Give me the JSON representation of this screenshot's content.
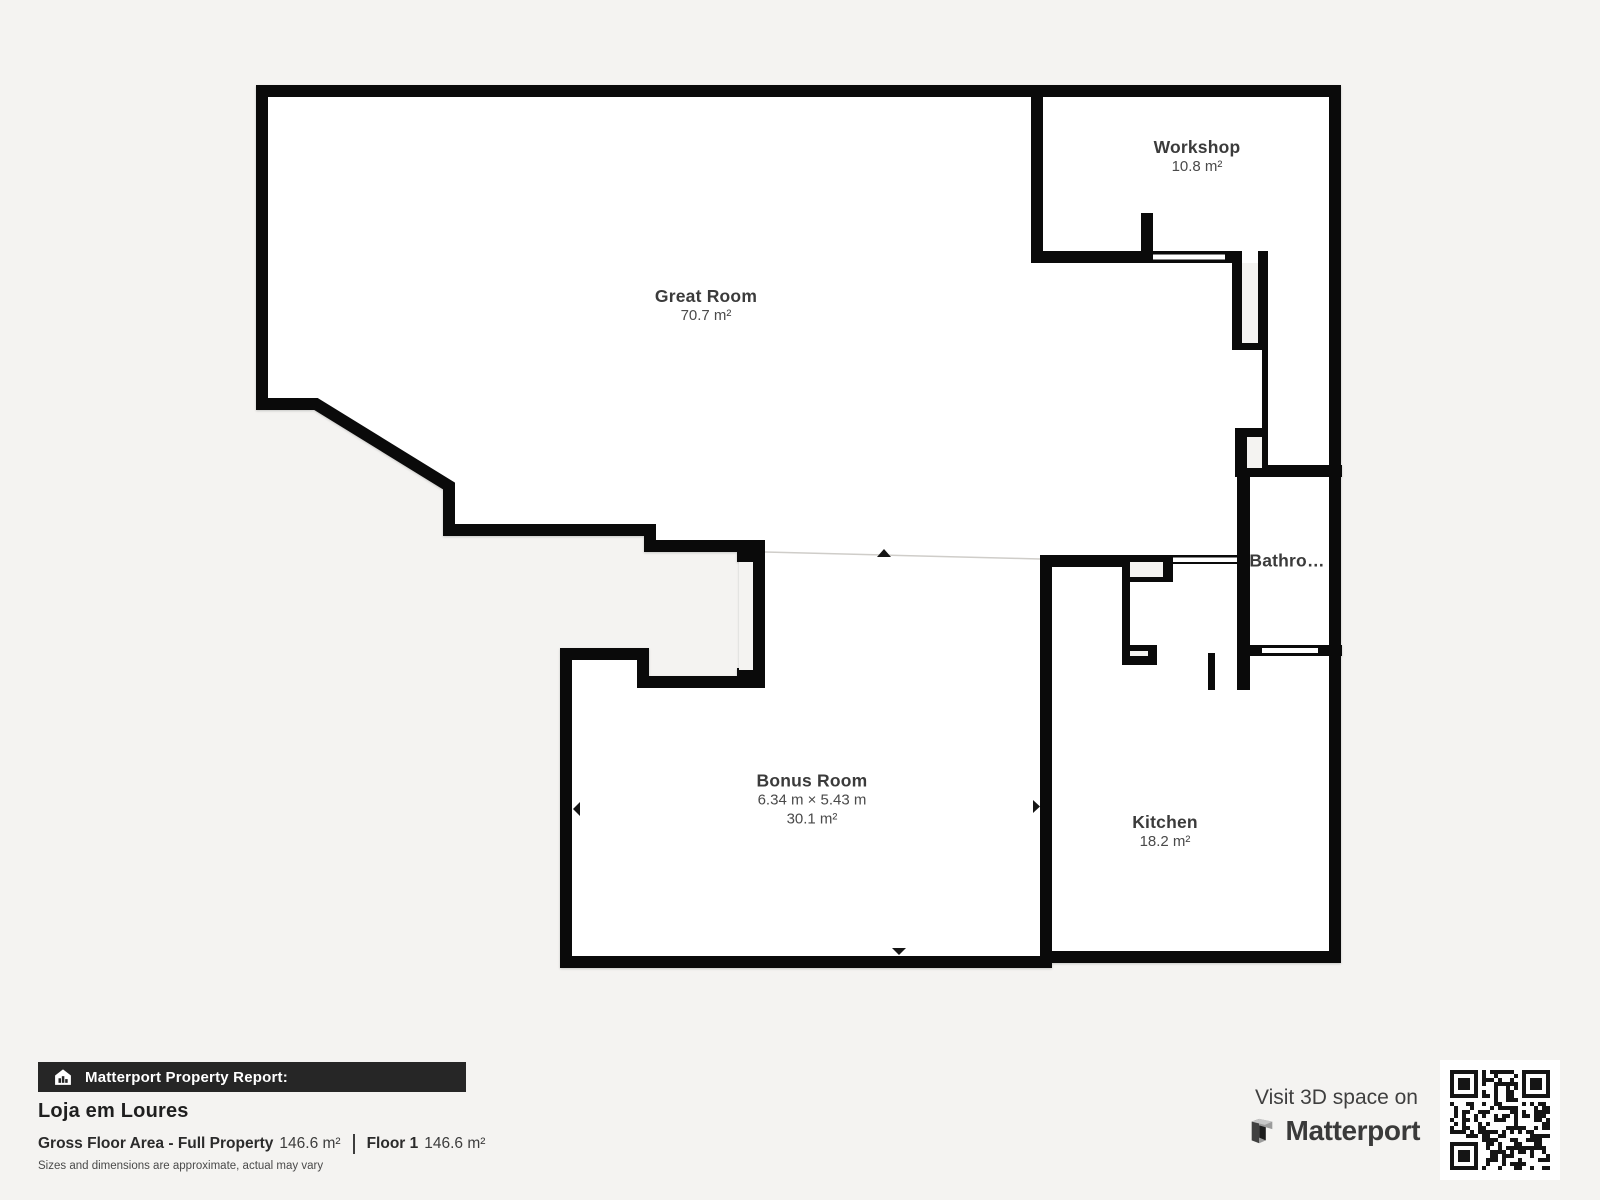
{
  "colors": {
    "background": "#f4f3f1",
    "wall": "#0a0a0a",
    "room_fill": "#ffffff",
    "report_bar_bg": "#262626"
  },
  "floorplan": {
    "rooms": [
      {
        "id": "great-room",
        "name": "Great Room",
        "area": "70.7 m²"
      },
      {
        "id": "workshop",
        "name": "Workshop",
        "area": "10.8 m²"
      },
      {
        "id": "bathroom",
        "name": "Bathro…"
      },
      {
        "id": "bonus-room",
        "name": "Bonus Room",
        "dimensions": "6.34 m × 5.43 m",
        "area": "30.1 m²"
      },
      {
        "id": "kitchen",
        "name": "Kitchen",
        "area": "18.2 m²"
      }
    ]
  },
  "report": {
    "bar_label": "Matterport Property Report:",
    "property_name": "Loja em Loures",
    "gross_label": "Gross Floor Area - Full Property",
    "gross_value": "146.6 m²",
    "floor_label": "Floor 1",
    "floor_value": "146.6 m²",
    "disclaimer": "Sizes and dimensions are approximate, actual may vary"
  },
  "cta": {
    "visit_text": "Visit 3D space on",
    "brand": "Matterport"
  }
}
